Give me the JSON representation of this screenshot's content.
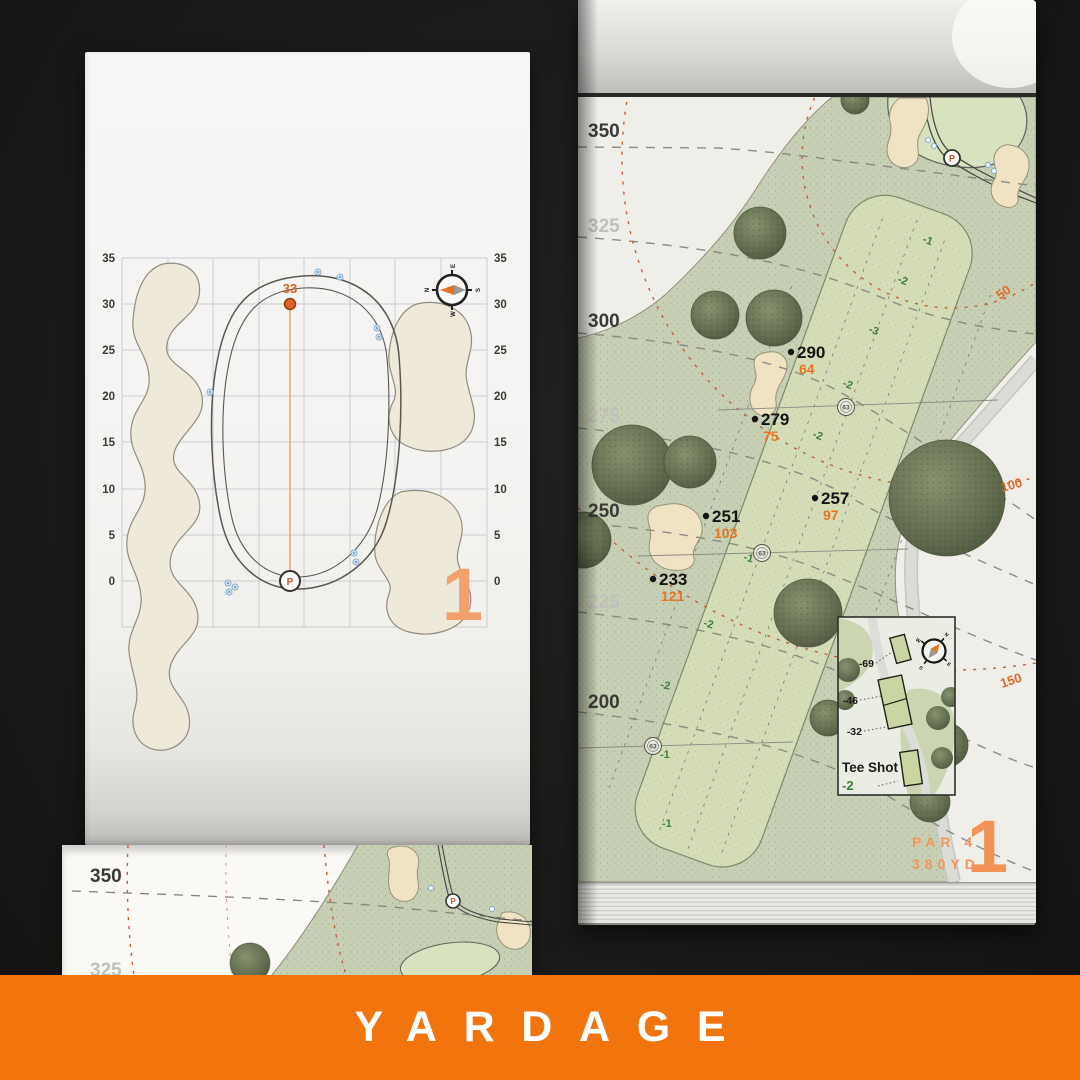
{
  "banner": {
    "label": "YARDAGE"
  },
  "compass": {
    "n": "N",
    "e": "E",
    "s": "S",
    "w": "W"
  },
  "left_page": {
    "hole_number": "1",
    "pin_distance": "33",
    "pin_symbol": "P",
    "axis_labels": [
      "35",
      "30",
      "25",
      "20",
      "15",
      "10",
      "5",
      "0"
    ]
  },
  "under_page": {
    "contour_labels": [
      "350",
      "325"
    ]
  },
  "right_page": {
    "hole_number": "1",
    "par_label": "PAR 4",
    "yardage_label": "380YD",
    "pin_symbol": "P",
    "contour_labels": [
      "350",
      "325",
      "300",
      "275",
      "250",
      "225",
      "200"
    ],
    "arc_labels": [
      "50",
      "100",
      "150"
    ],
    "sprinkler_label": "63",
    "markers": [
      {
        "distance": "290",
        "carry": "64"
      },
      {
        "distance": "279",
        "carry": "75"
      },
      {
        "distance": "257",
        "carry": "97"
      },
      {
        "distance": "251",
        "carry": "103"
      },
      {
        "distance": "233",
        "carry": "121"
      }
    ],
    "elevations": [
      "-1",
      "-2",
      "-3",
      "-2",
      "-2",
      "-1",
      "-2",
      "-2",
      "-1",
      "-1"
    ],
    "inset": {
      "title": "Tee Shot",
      "total": "-2",
      "tee_labels": [
        "-69",
        "-46",
        "-32"
      ]
    }
  },
  "colors": {
    "accent_orange": "#F2740D",
    "carry_orange": "#E8731F",
    "elevation_green": "#3E7C3A",
    "paper": "#F4F3F1",
    "rough_green": "#C7D0B4",
    "fairway_green": "#D4DDB7",
    "sand": "#EFE3C4",
    "tree_green": "#6B7656",
    "sprinkler_blue": "#7FA8CF"
  }
}
